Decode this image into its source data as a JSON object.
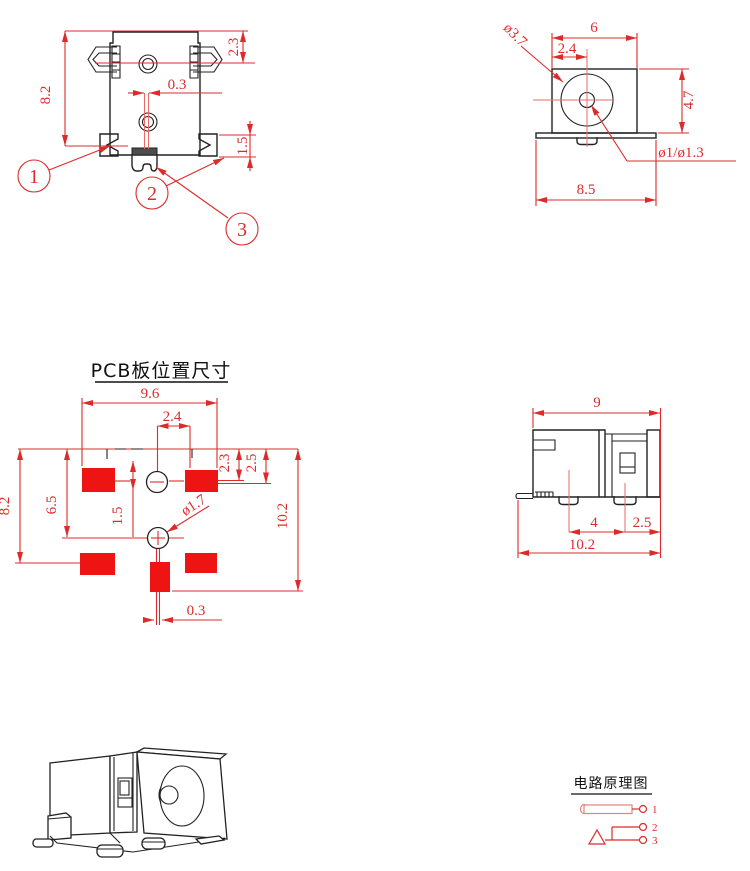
{
  "colors": {
    "dimension_red": "#dd2b2b",
    "pad_red": "#ee1414",
    "line_black": "#222222"
  },
  "views": {
    "front": {
      "dims": {
        "height": "8.2",
        "top_offset": "2.3",
        "slot_width": "0.3",
        "tab_height": "1.5"
      },
      "callouts": {
        "c1": "1",
        "c2": "2",
        "c3": "3"
      }
    },
    "barrel_face": {
      "dims": {
        "width": "6",
        "center_offset": "2.4",
        "height": "4.7",
        "flange_width": "8.5",
        "barrel_dia": "ø3.7",
        "pin_dia": "ø1/ø1.3"
      }
    },
    "pcb": {
      "title": "PCB板位置尺寸",
      "dims": {
        "pad_span": "9.6",
        "pin_offset": "2.4",
        "overall_height": "8.2",
        "body_height": "6.5",
        "hole_offset": "1.5",
        "pad_top": "2.3",
        "hole_top": "2.5",
        "total_height": "10.2",
        "hole_dia": "ø1.7",
        "slot_width": "0.3"
      }
    },
    "side_profile": {
      "dims": {
        "width": "9",
        "foot_pitch": "4",
        "foot_edge": "2.5",
        "total_width": "10.2"
      }
    },
    "schematic": {
      "title": "电路原理图",
      "pins": {
        "p1": "1",
        "p2": "2",
        "p3": "3"
      }
    }
  }
}
